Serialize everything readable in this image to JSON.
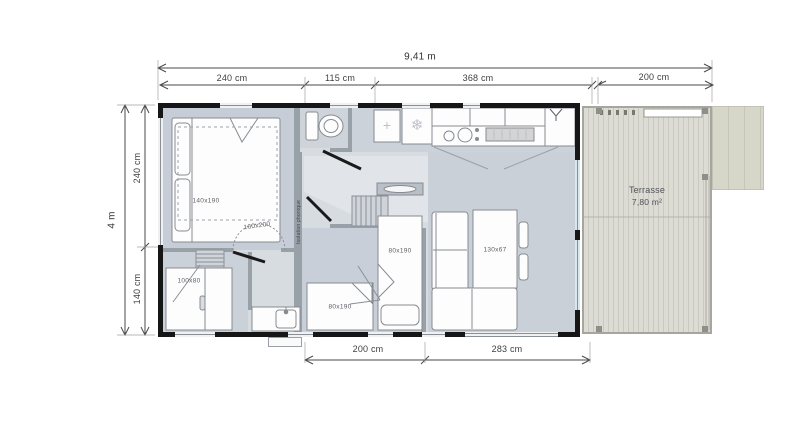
{
  "dimensions": {
    "overall_width": "9,41 m",
    "overall_depth": "4 m",
    "top": [
      "240 cm",
      "115 cm",
      "368 cm",
      "200 cm"
    ],
    "left": [
      "240 cm",
      "140 cm"
    ],
    "bottom": [
      "200 cm",
      "283 cm"
    ]
  },
  "labels": {
    "master_bed": "140x190",
    "master_bed_alt": "160x200",
    "shower": "100x80",
    "single_bed_right": "80x190",
    "single_bed_bottom": "80x190",
    "dining_table": "130x67",
    "terrace_name": "Terrasse",
    "terrace_area": "7,80 m²",
    "insulation_note": "Isolation phonique"
  },
  "icons": {
    "freezer_glyph": "❄",
    "vent_glyph": "+"
  },
  "colors": {
    "exterior_wall": "#161616",
    "interior_wall": "#98a0a8",
    "floor": "#d7dce1",
    "room_tint": "#c7ced8",
    "terrace_deck": "#dcdcd5",
    "awning": "#d6d6c9",
    "dimension_line": "#4a4a4a",
    "window_glass": "#d8e6ee"
  }
}
